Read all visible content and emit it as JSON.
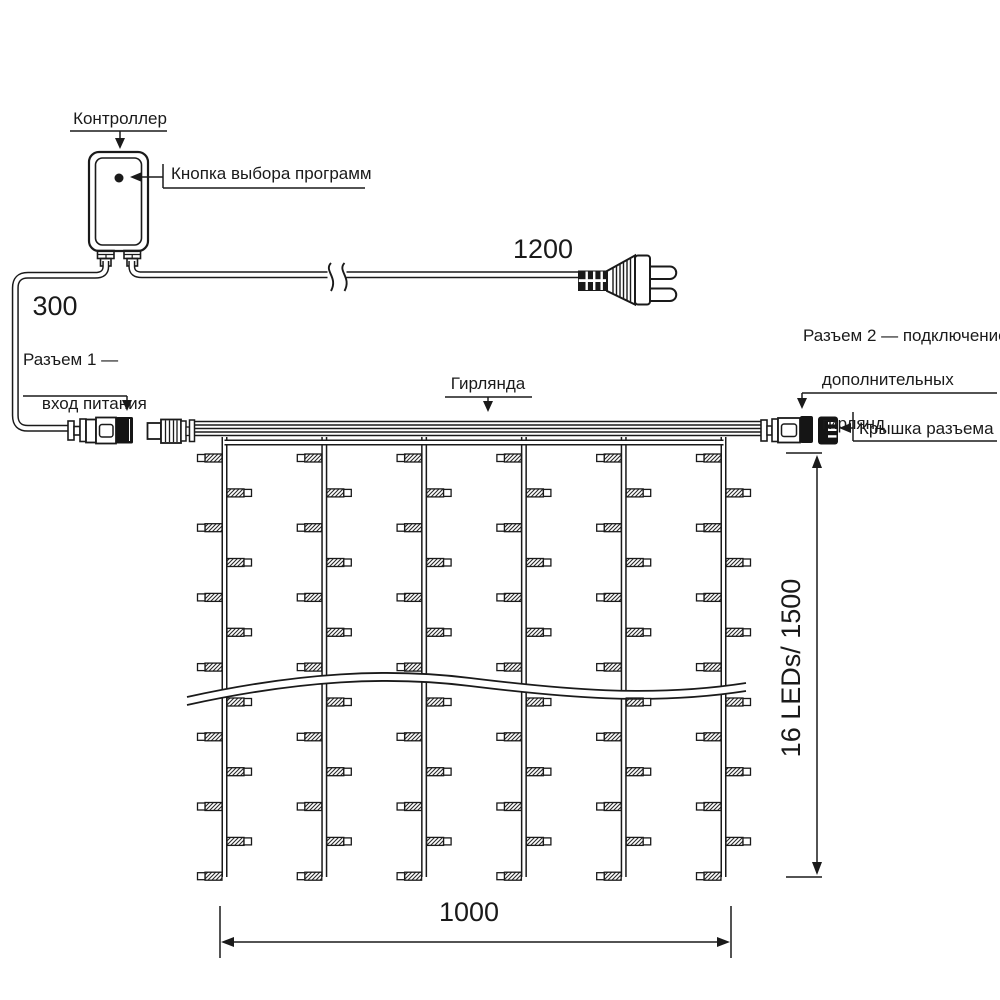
{
  "title": "Схема световой гирлянды-занавеса",
  "labels": {
    "controller": "Контроллер",
    "program_button": "Кнопка выбора программ",
    "connector1_line1": "Разъем 1 —",
    "connector1_line2": "вход питания",
    "garland": "Гирлянда",
    "connector2_line1": "Разъем 2 — подключение",
    "connector2_line2": "дополнительных",
    "connector2_line3": "гирлянд",
    "cap": "Крышка разъема"
  },
  "dimensions": {
    "controller_cord_length": "300",
    "power_cord_length": "1200",
    "curtain_width": "1000",
    "curtain_height": "16 LEDs/ 1500"
  },
  "diagram": {
    "strings_count": 6,
    "led_rows_visible": 13,
    "leds_per_string_spec": 16,
    "line_color": "#1a1a1a",
    "background": "#ffffff"
  }
}
